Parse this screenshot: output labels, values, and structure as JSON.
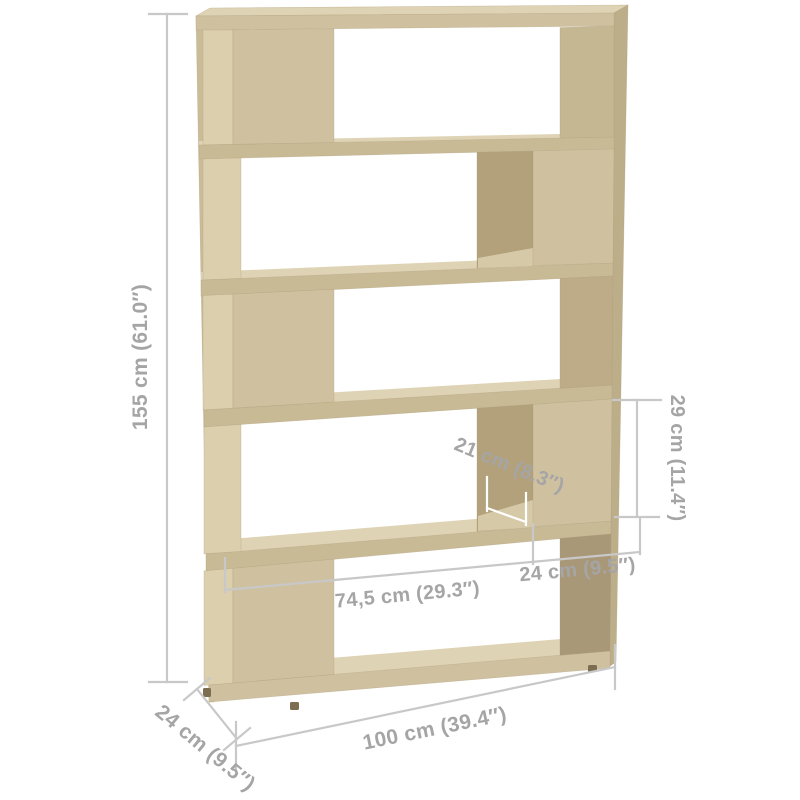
{
  "diagram": {
    "structure": {
      "tier_count": 5
    },
    "dimensions": {
      "height": {
        "label": "155 cm (61.0″)"
      },
      "width": {
        "label": "100 cm (39.4″)"
      },
      "depth": {
        "label": "24 cm (9.5″)"
      },
      "inner_width": {
        "label": "74,5 cm (29.3″)"
      },
      "inner_box_width": {
        "label": "24 cm (9.5″)"
      },
      "inner_depth": {
        "label": "21 cm (8.3″)"
      },
      "inner_height": {
        "label": "29 cm (11.4″)"
      }
    },
    "colors": {
      "background": "#ffffff",
      "wood_front": "#cfc19f",
      "wood_top": "#ded3b4",
      "wood_side": "#bdae8a",
      "wood_stile": "#cbbc98",
      "wood_shelf_front": "#c9ba96",
      "wood_inner_light": "#dbcfae",
      "wood_inner_shadow": "#b2a17b",
      "wood_floor": "#d6c9a8",
      "wood_right_inner_top": "#c6b793",
      "wood_right_inner_mid": "#bdac87",
      "wood_right_inner_bottom": "#a99877",
      "foot": "#7d6e52",
      "dimension_line": "#c8c8c8",
      "dimension_text": "#a5a5a5",
      "white_tick": "#ffffff"
    }
  }
}
